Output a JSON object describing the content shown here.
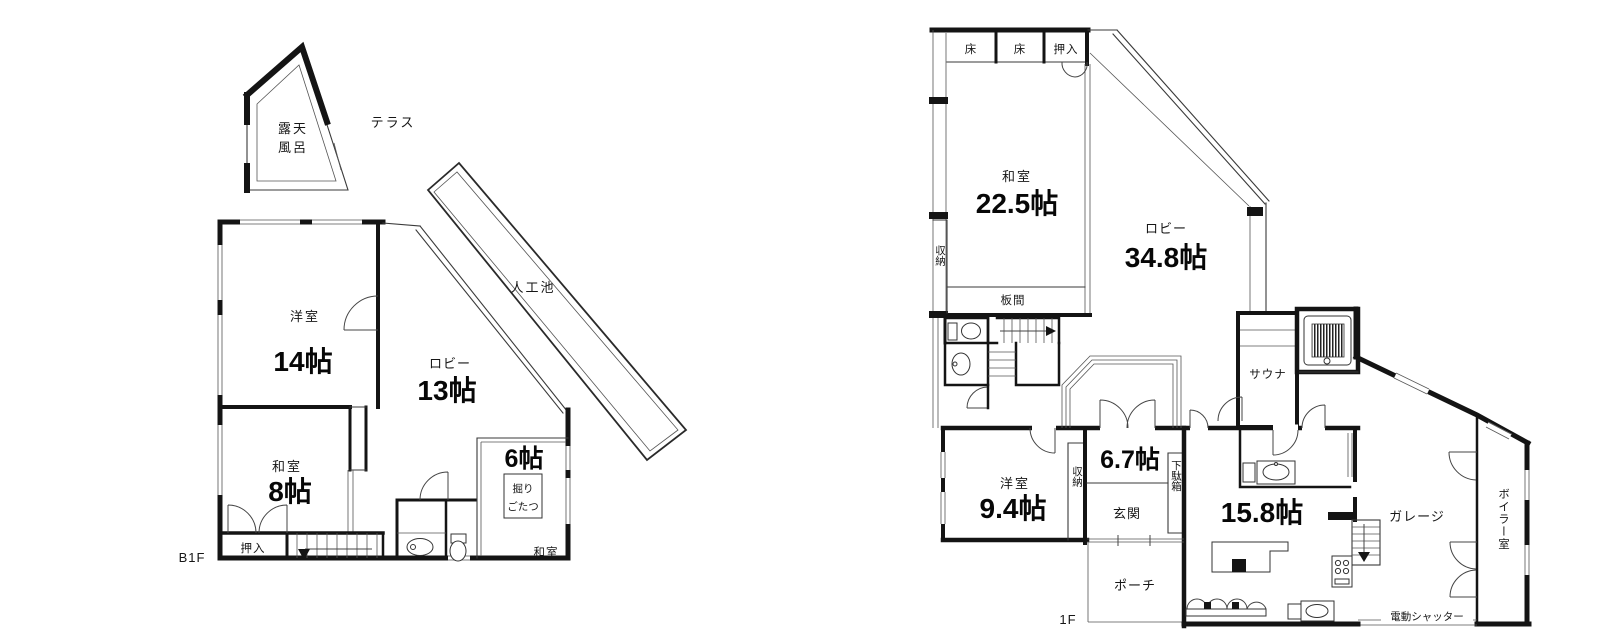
{
  "style": {
    "ink": "#141414",
    "paper": "#ffffff",
    "label_color": "#161616"
  },
  "b1f": {
    "floor_label": "B1F",
    "open_air_bath_line1": "露天",
    "open_air_bath_line2": "風呂",
    "terrace": "テラス",
    "pond": "人工池",
    "western_room_name": "洋室",
    "western_room_size": "14帖",
    "lobby_name": "ロビー",
    "lobby_size": "13帖",
    "japanese_room_name": "和室",
    "japanese_room_size": "8帖",
    "closet": "押入",
    "room6_size": "6帖",
    "kotatsu_line1": "掘り",
    "kotatsu_line2": "ごたつ",
    "room6_type": "和室"
  },
  "f1": {
    "floor_label": "1F",
    "alcove1": "床",
    "alcove2": "床",
    "closet_top": "押入",
    "japanese_room_name": "和室",
    "japanese_room_size": "22.5帖",
    "lobby_name": "ロビー",
    "lobby_size": "34.8帖",
    "storage_left": "収納",
    "wood_floor": "板間",
    "sauna": "サウナ",
    "western_room_name": "洋室",
    "western_room_size": "9.4帖",
    "storage_mid": "収納",
    "hall_size": "6.7帖",
    "entrance": "玄関",
    "shoe_cabinet": "下駄箱",
    "ldk_size": "15.8帖",
    "porch": "ポーチ",
    "garage": "ガレージ",
    "boiler_room": "ボイラー室",
    "shutter": "電動シャッター"
  }
}
